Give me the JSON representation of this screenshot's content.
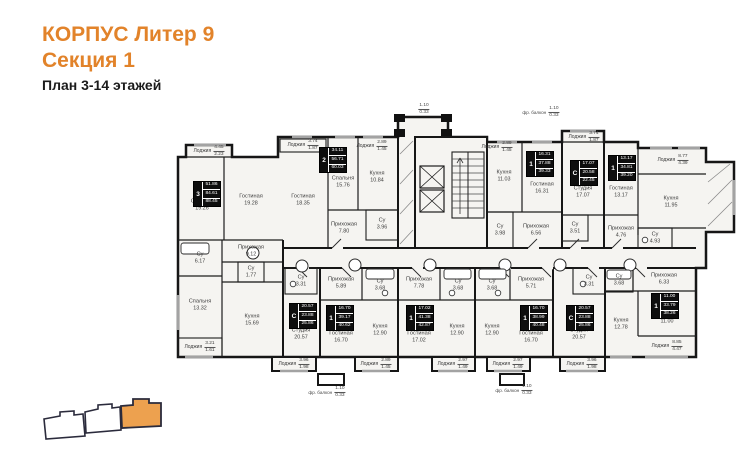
{
  "header": {
    "building": "КОРПУС Литер 9",
    "section": "Секция 1",
    "plan_range": "План 3-14 этажей"
  },
  "colors": {
    "accent_orange": "#e2832a",
    "locator_highlight": "#eda14f",
    "wall": "#161616",
    "plan_fill": "#f5f4f1"
  },
  "plan": {
    "rooms": [
      {
        "name": "Спальня",
        "area": "19.26",
        "x": 202,
        "y": 205
      },
      {
        "name": "Гостиная",
        "area": "19.28",
        "x": 251,
        "y": 200
      },
      {
        "name": "Гостиная",
        "area": "18.35",
        "x": 303,
        "y": 200
      },
      {
        "name": "Спальня",
        "area": "15.76",
        "x": 343,
        "y": 182
      },
      {
        "name": "Кухня",
        "area": "10.84",
        "x": 377,
        "y": 177
      },
      {
        "name": "Прихожая",
        "area": "7.80",
        "x": 344,
        "y": 228
      },
      {
        "name": "Су",
        "area": "3.96",
        "x": 382,
        "y": 224
      },
      {
        "name": "Прихожая",
        "area": "9.12",
        "x": 251,
        "y": 251
      },
      {
        "name": "Су",
        "area": "6.17",
        "x": 200,
        "y": 258
      },
      {
        "name": "Су",
        "area": "1.77",
        "x": 251,
        "y": 272
      },
      {
        "name": "Спальня",
        "area": "13.32",
        "x": 200,
        "y": 305
      },
      {
        "name": "Кухня",
        "area": "15.69",
        "x": 252,
        "y": 320
      },
      {
        "name": "Кухня",
        "area": "11.03",
        "x": 504,
        "y": 176
      },
      {
        "name": "Гостиная",
        "area": "16.31",
        "x": 542,
        "y": 188
      },
      {
        "name": "Су",
        "area": "3.98",
        "x": 500,
        "y": 230
      },
      {
        "name": "Прихожая",
        "area": "6.56",
        "x": 536,
        "y": 230
      },
      {
        "name": "Студия",
        "area": "17.07",
        "x": 583,
        "y": 192
      },
      {
        "name": "Су",
        "area": "3.51",
        "x": 575,
        "y": 228
      },
      {
        "name": "Гостиная",
        "area": "13.17",
        "x": 621,
        "y": 192
      },
      {
        "name": "Кухня",
        "area": "11.95",
        "x": 671,
        "y": 202
      },
      {
        "name": "Прихожая",
        "area": "4.76",
        "x": 621,
        "y": 232
      },
      {
        "name": "Су",
        "area": "4.93",
        "x": 655,
        "y": 238
      },
      {
        "name": "Су",
        "area": "3.31",
        "x": 301,
        "y": 281
      },
      {
        "name": "Студия",
        "area": "20.57",
        "x": 301,
        "y": 334
      },
      {
        "name": "Прихожая",
        "area": "5.89",
        "x": 341,
        "y": 283
      },
      {
        "name": "Су",
        "area": "3.68",
        "x": 380,
        "y": 285
      },
      {
        "name": "Гостиная",
        "area": "16.70",
        "x": 341,
        "y": 337
      },
      {
        "name": "Кухня",
        "area": "12.90",
        "x": 380,
        "y": 330
      },
      {
        "name": "Прихожая",
        "area": "7.78",
        "x": 419,
        "y": 283
      },
      {
        "name": "Су",
        "area": "3.68",
        "x": 458,
        "y": 285
      },
      {
        "name": "Гостиная",
        "area": "17.02",
        "x": 419,
        "y": 337
      },
      {
        "name": "Кухня",
        "area": "12.90",
        "x": 457,
        "y": 330
      },
      {
        "name": "Су",
        "area": "3.68",
        "x": 492,
        "y": 285
      },
      {
        "name": "Прихожая",
        "area": "5.71",
        "x": 531,
        "y": 283
      },
      {
        "name": "Кухня",
        "area": "12.90",
        "x": 492,
        "y": 330
      },
      {
        "name": "Гостиная",
        "area": "16.70",
        "x": 531,
        "y": 337
      },
      {
        "name": "Су",
        "area": "3.31",
        "x": 589,
        "y": 281
      },
      {
        "name": "Студия",
        "area": "20.57",
        "x": 579,
        "y": 334
      },
      {
        "name": "Су",
        "area": "3.68",
        "x": 619,
        "y": 280
      },
      {
        "name": "Прихожая",
        "area": "6.33",
        "x": 664,
        "y": 279
      },
      {
        "name": "Кухня",
        "area": "12.78",
        "x": 621,
        "y": 324
      },
      {
        "name": "Спальня",
        "area": "11.00",
        "x": 667,
        "y": 318
      }
    ],
    "loggias": [
      {
        "name": "Лоджия",
        "full": "4.45",
        "half": "2.23",
        "x": 209,
        "y": 151
      },
      {
        "name": "Лоджия",
        "full": "3.74",
        "half": "1.87",
        "x": 303,
        "y": 145
      },
      {
        "name": "Лоджия",
        "full": "2.89",
        "half": "1.45",
        "x": 372,
        "y": 146
      },
      {
        "name": "Лоджия",
        "full": "2.89",
        "half": "1.45",
        "x": 497,
        "y": 147
      },
      {
        "name": "Лоджия",
        "full": "3.74",
        "half": "1.87",
        "x": 584,
        "y": 137
      },
      {
        "name": "Лоджия",
        "full": "8.77",
        "half": "4.39",
        "x": 673,
        "y": 160
      },
      {
        "name": "Лоджия",
        "full": "3.21",
        "half": "1.61",
        "x": 200,
        "y": 347
      },
      {
        "name": "Лоджия",
        "full": "3.96",
        "half": "1.98",
        "x": 294,
        "y": 364
      },
      {
        "name": "Лоджия",
        "full": "2.89",
        "half": "1.45",
        "x": 376,
        "y": 364
      },
      {
        "name": "Лоджия",
        "full": "2.97",
        "half": "1.49",
        "x": 453,
        "y": 364
      },
      {
        "name": "Лоджия",
        "full": "2.97",
        "half": "1.49",
        "x": 508,
        "y": 364
      },
      {
        "name": "Лоджия",
        "full": "3.96",
        "half": "1.98",
        "x": 582,
        "y": 364
      },
      {
        "name": "Лоджия",
        "full": "8.85",
        "half": "4.47",
        "x": 667,
        "y": 346
      }
    ],
    "apartments": [
      {
        "rooms": "3",
        "living": "51.86",
        "area": "84.61",
        "total": "88.45",
        "x": 193,
        "y": 181
      },
      {
        "rooms": "2",
        "living": "34.11",
        "area": "56.71",
        "total": "60.03",
        "x": 319,
        "y": 147
      },
      {
        "rooms": "1",
        "living": "16.31",
        "area": "37.88",
        "total": "39.33",
        "x": 526,
        "y": 151
      },
      {
        "rooms": "С",
        "living": "17.07",
        "area": "20.58",
        "total": "22.45",
        "x": 570,
        "y": 160
      },
      {
        "rooms": "1",
        "living": "13.17",
        "area": "34.81",
        "total": "39.20",
        "x": 608,
        "y": 155
      },
      {
        "rooms": "С",
        "living": "20.57",
        "area": "23.88",
        "total": "25.86",
        "x": 289,
        "y": 303
      },
      {
        "rooms": "1",
        "living": "16.70",
        "area": "39.17",
        "total": "40.62",
        "x": 326,
        "y": 305
      },
      {
        "rooms": "1",
        "living": "17.02",
        "area": "41.38",
        "total": "42.87",
        "x": 406,
        "y": 305
      },
      {
        "rooms": "1",
        "living": "16.70",
        "area": "38.99",
        "total": "40.48",
        "x": 520,
        "y": 305
      },
      {
        "rooms": "С",
        "living": "20.57",
        "area": "23.88",
        "total": "25.86",
        "x": 566,
        "y": 305
      },
      {
        "rooms": "1",
        "living": "11.00",
        "area": "33.79",
        "total": "38.26",
        "x": 651,
        "y": 293
      }
    ],
    "balconies": [
      {
        "name": "",
        "full": "1.10",
        "half": "0.33",
        "x": 424,
        "y": 109
      },
      {
        "name": "фр. балкон",
        "full": "1.10",
        "half": "0.33",
        "x": 541,
        "y": 112
      },
      {
        "name": "фр. балкон",
        "full": "1.10",
        "half": "0.33",
        "x": 327,
        "y": 392
      },
      {
        "name": "фр. балкон",
        "full": "1.10",
        "half": "0.33",
        "x": 514,
        "y": 390
      }
    ]
  },
  "locator": {
    "sections_total": 3,
    "highlighted_section": "Секция 1"
  }
}
